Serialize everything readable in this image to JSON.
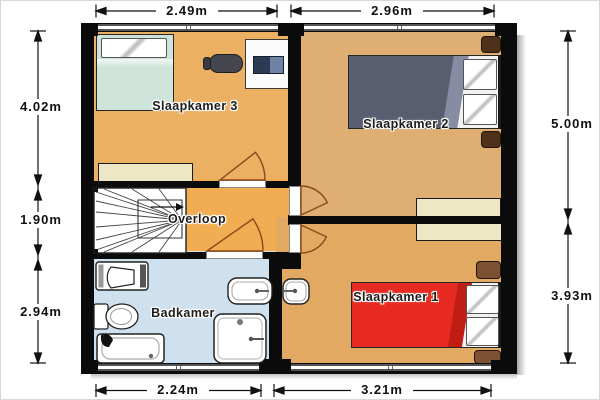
{
  "rooms": [
    {
      "name": "slaapkamer-3",
      "label": "Slaapkamer 3"
    },
    {
      "name": "slaapkamer-2",
      "label": "Slaapkamer 2"
    },
    {
      "name": "overloop",
      "label": "Overloop"
    },
    {
      "name": "badkamer",
      "label": "Badkamer"
    },
    {
      "name": "slaapkamer-1",
      "label": "Slaapkamer 1"
    }
  ],
  "dimensions": {
    "top": [
      "2.49m",
      "2.96m"
    ],
    "bottom": [
      "2.24m",
      "3.21m"
    ],
    "left": [
      "4.02m",
      "1.90m",
      "2.94m"
    ],
    "right": [
      "5.00m",
      "3.93m"
    ]
  },
  "furniture": {
    "slaapkamer_3": [
      "single-bed",
      "desk",
      "laptop",
      "office-chair",
      "dresser"
    ],
    "slaapkamer_2": [
      "double-bed",
      "nightstand",
      "nightstand",
      "wardrobe"
    ],
    "overloop": [
      "staircase",
      "direction-arrow"
    ],
    "badkamer": [
      "toilet",
      "toilet",
      "bathtub",
      "shower",
      "washbasin"
    ],
    "slaapkamer_1": [
      "double-bed",
      "nightstand",
      "nightstand",
      "wardrobe",
      "washbasin"
    ]
  },
  "colors": {
    "wall": "#0b0b0b",
    "floor_bedroom_3": "#ecb063",
    "floor_bedroom_2": "#deae72",
    "floor_bedroom_1": "#e2a963",
    "floor_landing": "#f2ad53",
    "floor_bathroom": "#cfe0ee",
    "bed_1_red": "#e62a21",
    "bed_2_dark": "#585d70",
    "bed_3_teal": "#cee4da",
    "nightstand_dark": "#4f3018",
    "nightstand_light": "#7d5233",
    "cabinet_cream": "#ede7c5",
    "door_swing": "#8a4a1a"
  }
}
